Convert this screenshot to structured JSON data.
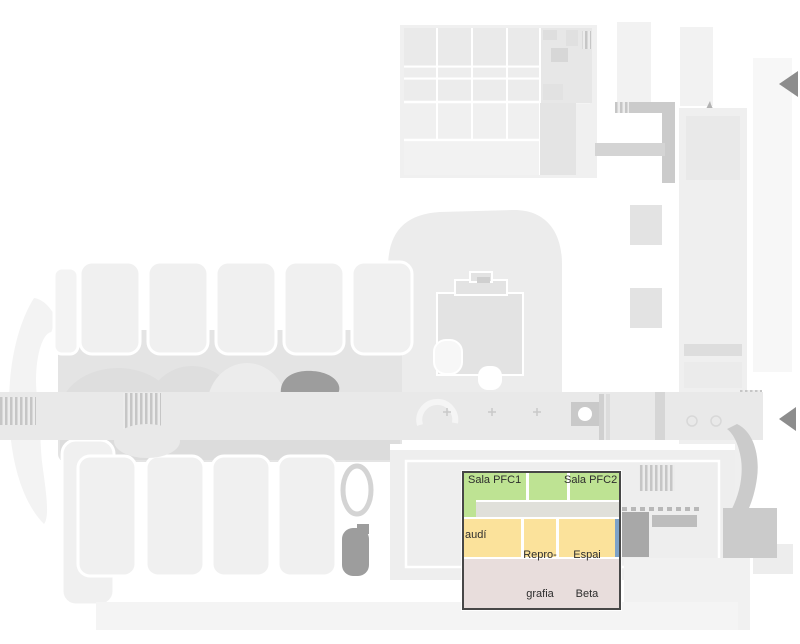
{
  "map": {
    "background_color": "#ffffff",
    "selection_box": {
      "border_color": "#474747"
    },
    "arrow_color": "#8d8d8d",
    "arrows": [
      {
        "id": "top-right",
        "direction": "left"
      },
      {
        "id": "middle-right",
        "direction": "left"
      }
    ]
  },
  "rooms": [
    {
      "id": "sala-pfc1",
      "label": "Sala PFC1",
      "color": "#bee393"
    },
    {
      "id": "sala-pfc2",
      "label": "Sala PFC2",
      "color": "#bee393"
    },
    {
      "id": "gaudi",
      "label": "audí",
      "color": "#fbe29b"
    },
    {
      "id": "reprografia",
      "label_line1": "Repro-",
      "label_line2": "grafia",
      "color": "#fbe29b"
    },
    {
      "id": "espai-beta",
      "label_line1": "Espai",
      "label_line2": "Beta",
      "color": "#fbe29b"
    }
  ],
  "zones": {
    "corridor_color": "#e0e0da",
    "blue_room_color": "#7da2c8",
    "pink_area_color": "#e8dddc"
  }
}
